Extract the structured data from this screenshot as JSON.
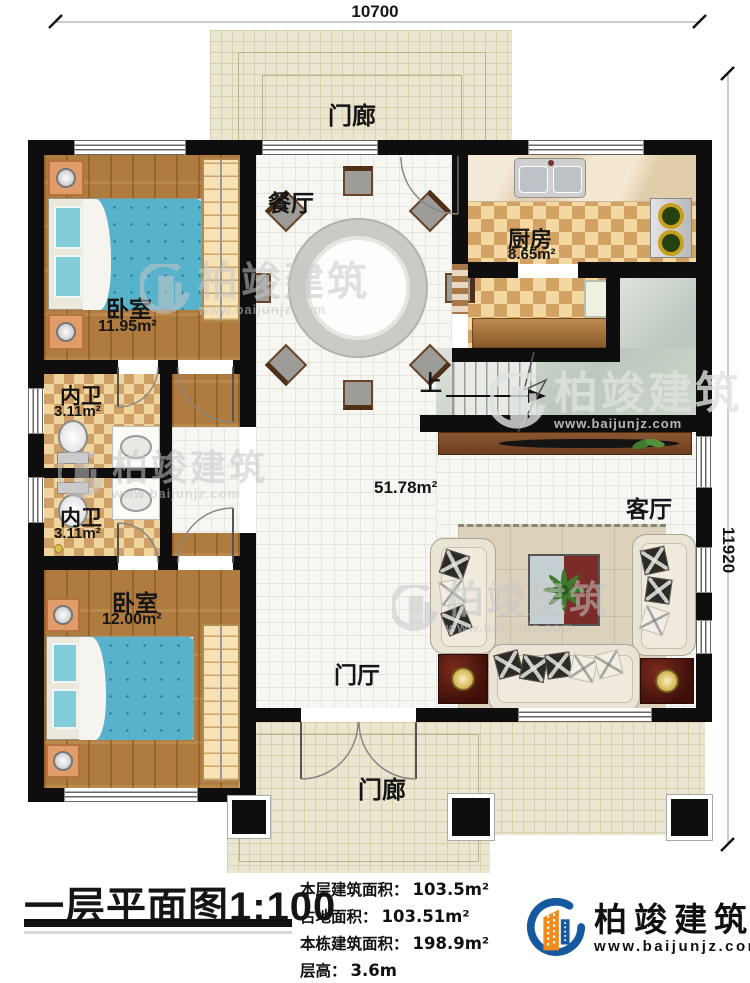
{
  "title": {
    "text": "一层平面图1:100"
  },
  "dimensions": {
    "top": "10700",
    "right": "11920"
  },
  "rooms": {
    "porch_top": {
      "label": "门廊"
    },
    "porch_bottom": {
      "label": "门廊"
    },
    "dining": {
      "label": "餐厅"
    },
    "kitchen": {
      "label": "厨房",
      "area": "8.65m²"
    },
    "bedroom1": {
      "label": "卧室",
      "area": "11.95m²"
    },
    "bath1": {
      "label": "内卫",
      "area": "3.11m²"
    },
    "bath2": {
      "label": "内卫",
      "area": "3.11m²"
    },
    "bedroom2": {
      "label": "卧室",
      "area": "12.00m²"
    },
    "hall": {
      "area": "51.78m²"
    },
    "living": {
      "label": "客厅"
    },
    "foyer": {
      "label": "门厅"
    },
    "stairs": {
      "up_label": "上"
    }
  },
  "stats": [
    {
      "label": "本层建筑面积：",
      "value": "103.5m²"
    },
    {
      "label": "占地面积：",
      "value": "103.51m²"
    },
    {
      "label": "本栋建筑面积：",
      "value": "198.9m²"
    },
    {
      "label": "层高：",
      "value": "3.6m"
    }
  ],
  "logo": {
    "name": "柏竣建筑",
    "url": "www.baijunjz.com"
  },
  "watermark": {
    "name": "柏竣建筑",
    "url": "www.baijunjz.com"
  },
  "colors": {
    "wall": "#0e0e0e",
    "wood_floor": "#b07b3e",
    "tile_checker": "#cfa066",
    "porch_floor": "#eae6cf",
    "stair_hall_floor": "#c5cfc4",
    "bed": "#57b2cc",
    "logo_blue": "#15599f",
    "logo_orange": "#f08c1e"
  }
}
